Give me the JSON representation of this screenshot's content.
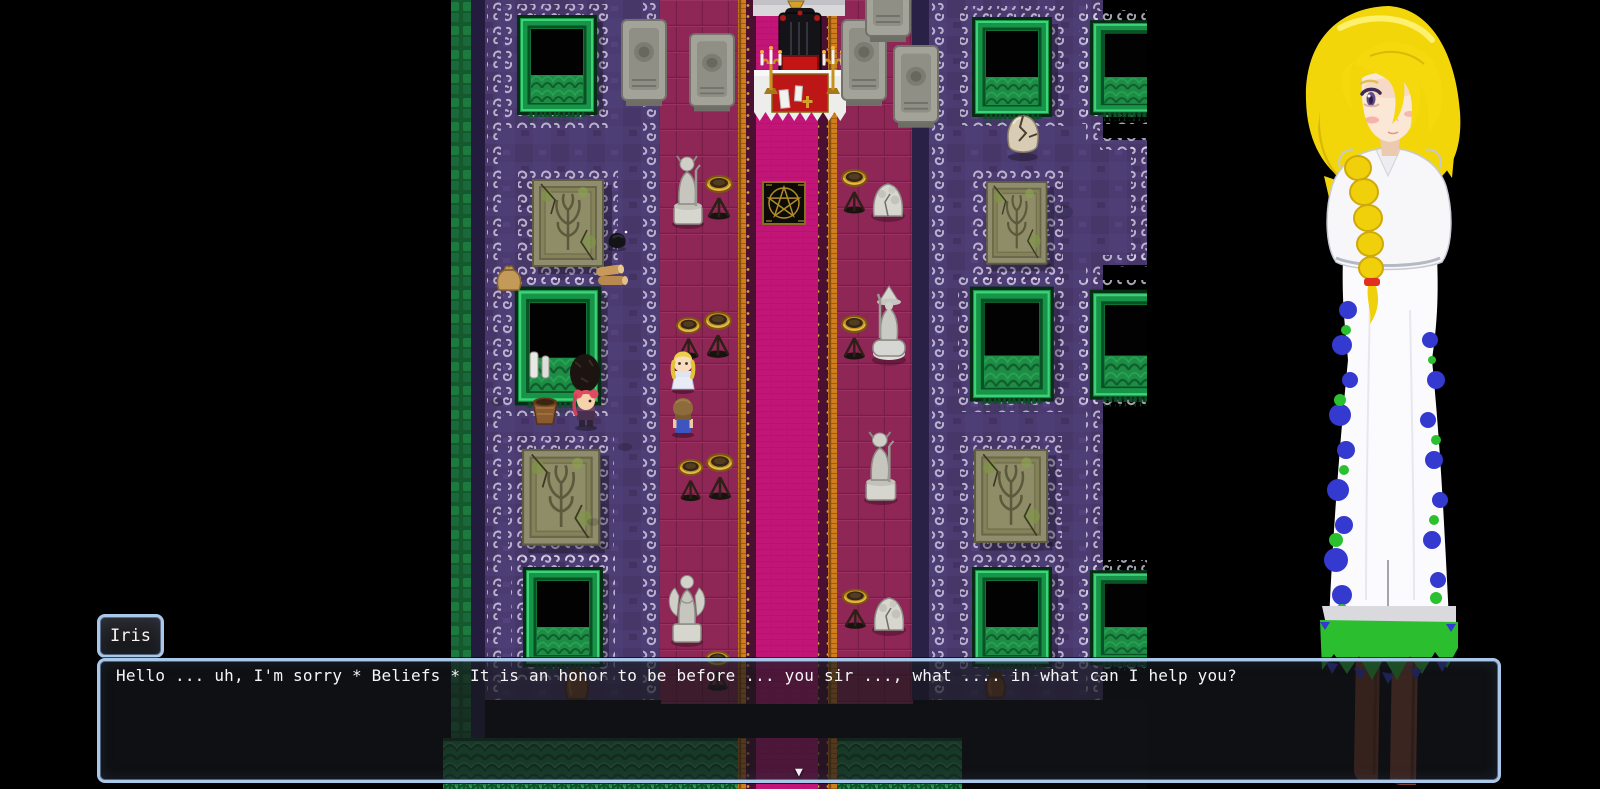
{
  "window": {
    "speaker": "Iris",
    "message": "Hello ... uh, I'm sorry * Beliefs * It is an honor to be before ... you sir ..., what .... in what can I help you?",
    "continue_indicator": "▼"
  },
  "colors": {
    "window_border": "#a9c7e8",
    "window_bg": "rgba(22,24,28,0.68)",
    "text": "#f6f6f6",
    "floor_purple": "#4b3b71",
    "aisle_magenta": "#8e2656",
    "carpet_pink": "#c11677",
    "orange_trim": "#d07d1e",
    "pit_green": "#169447",
    "portrait_hair": "#f3d60a",
    "portrait_dress": "#fbfbfd"
  }
}
